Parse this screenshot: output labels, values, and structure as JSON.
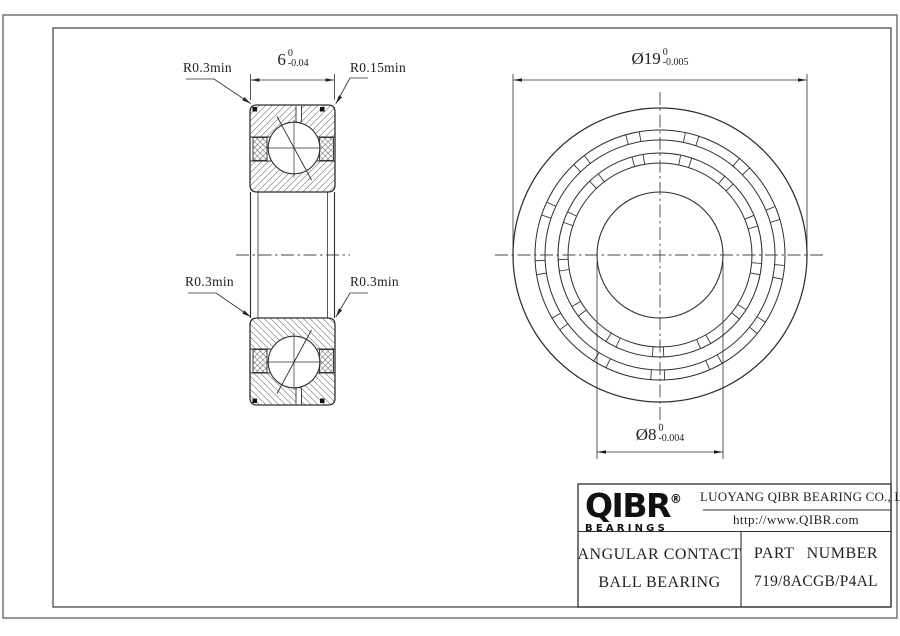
{
  "colors": {
    "line": "#2e2e2e",
    "background": "#ffffff",
    "border_outer": "#7d7d7d"
  },
  "section_view": {
    "width_dim": {
      "main": "6",
      "tol_top": "0",
      "tol_bottom": "-0.04"
    },
    "corner_labels": {
      "top_left": "R0.3min",
      "top_right": "R0.15min",
      "mid_left": "R0.3min",
      "mid_right": "R0.3min"
    }
  },
  "front_view": {
    "outer_dia_dim": {
      "main": "Ø19",
      "tol_top": "0",
      "tol_bottom": "-0.005"
    },
    "bore_dia_dim": {
      "main": "Ø8",
      "tol_top": "0",
      "tol_bottom": "-0.004"
    }
  },
  "title_block": {
    "logo_text": "QIBR",
    "logo_registered": "®",
    "logo_subtext": "BEARINGS",
    "company_name": "LUOYANG QIBR BEARING CO., LTD",
    "website": "http://www.QIBR.com",
    "product_type_line1": "ANGULAR CONTACT",
    "product_type_line2": "BALL BEARING",
    "part_number_label": "PART NUMBER",
    "part_number_value": "719/8ACGB/P4AL"
  }
}
